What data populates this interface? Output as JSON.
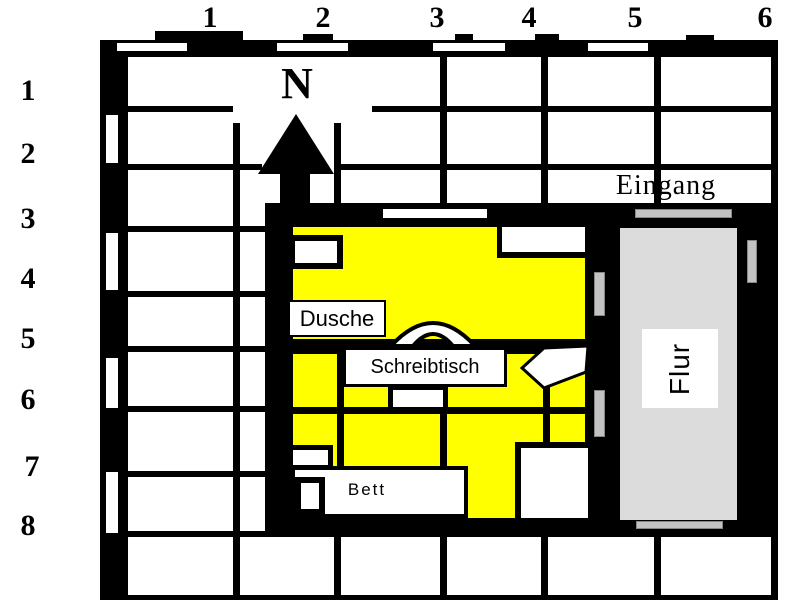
{
  "map": {
    "title": "Lageplan Zimmer (floor plan on grid)",
    "compass_label": "N",
    "entrance_label": "Eingang",
    "grid": {
      "column_labels": [
        "1",
        "2",
        "3",
        "4",
        "5",
        "6"
      ],
      "row_labels": [
        "1",
        "2",
        "3",
        "4",
        "5",
        "6",
        "7",
        "8"
      ]
    },
    "rooms": {
      "corridor_label": "Flur",
      "shower_label": "Dusche",
      "desk_label": "Schreibtisch",
      "bed_label": "Bett"
    },
    "colors": {
      "room_fill": "#ffff00",
      "corridor_fill": "#dcdcdc",
      "door_marker": "#c3c3c3",
      "wall": "#000000",
      "background": "#ffffff"
    }
  }
}
